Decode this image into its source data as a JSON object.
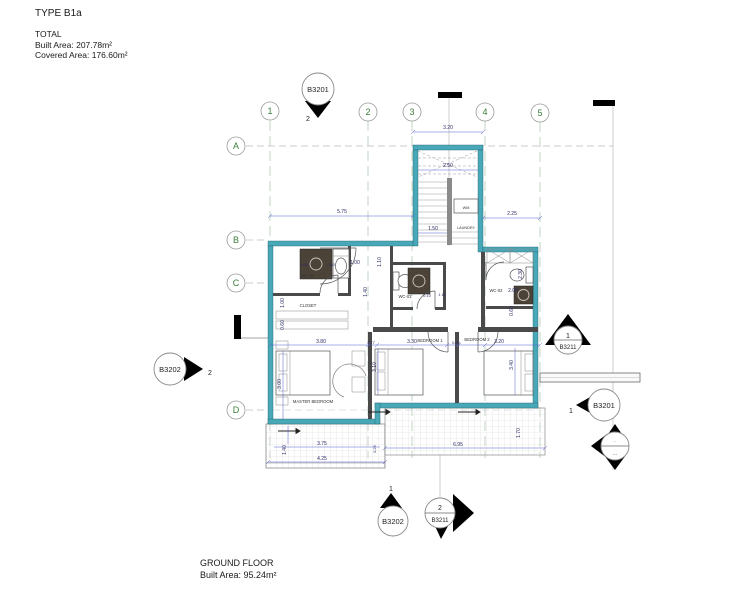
{
  "title_block": {
    "type": "TYPE B1a",
    "total": "TOTAL",
    "built": "Built Area: 207.78m²",
    "covered": "Covered Area: 176.60m²"
  },
  "footer": {
    "floor": "GROUND FLOOR",
    "built": "Built Area: 95.24m²"
  },
  "grid": {
    "cols": [
      "1",
      "2",
      "3",
      "4",
      "5"
    ],
    "rows": [
      "A",
      "B",
      "C",
      "D"
    ]
  },
  "markers": {
    "top": {
      "label": "B3201",
      "num": "2"
    },
    "west": {
      "label": "B3202",
      "num": "2"
    },
    "east_elev": {
      "num": "1",
      "label": "B3211"
    },
    "east_sec": {
      "num": "1",
      "label": "B3201"
    },
    "south_sec": {
      "num": "1",
      "label": "B3202"
    },
    "south_elev": {
      "num": "2",
      "label": "B3211"
    },
    "compass": {
      "top": "·",
      "bottom": "···"
    }
  },
  "rooms": {
    "master": "MASTER BEDROOM",
    "closet": "CLOSET",
    "wc04": "WC-04",
    "wc03": "WC-03",
    "wc02": "WC-02",
    "bed1": "BEDROOM 1",
    "bed2": "BEDROOM 2",
    "laundry": "LAUNDRY",
    "wm": "WM"
  },
  "dims": {
    "tower_top": "3.20",
    "stair_w": "2.50",
    "left_top": "5.75",
    "stair_b": "1.50",
    "right_top": "2.25",
    "hall_w": "1.00",
    "hall_h": "1.10",
    "wc04_a": "0.90",
    "wc04_b": "0.60",
    "closet_a": "1.00",
    "closet_b": "0.60",
    "wc03_a": "0.10",
    "wc03_b": "1.11",
    "wc03_h": "1.40",
    "wc02_w": "2.00",
    "wc02_h": "2.30",
    "wc02_b": "0.60",
    "master_w": "3.80",
    "gap1": "0.77",
    "bed1_w": "3.30",
    "gap2": "0.80",
    "bed2_w": "3.20",
    "master_h": "3.00",
    "bed1_h": "3.10",
    "bed2_h": "3.40",
    "balc_a": "3.75",
    "balc_b": "4.25",
    "balc_h": "1.40",
    "balc_c": "0.25",
    "terr_w": "6.95",
    "terr_h": "1.70"
  },
  "colors": {
    "wall": "#49A8B8",
    "dimension": "#4550BE",
    "grid_label": "#3A7D3A",
    "fixture_dark": "#4B4238"
  }
}
